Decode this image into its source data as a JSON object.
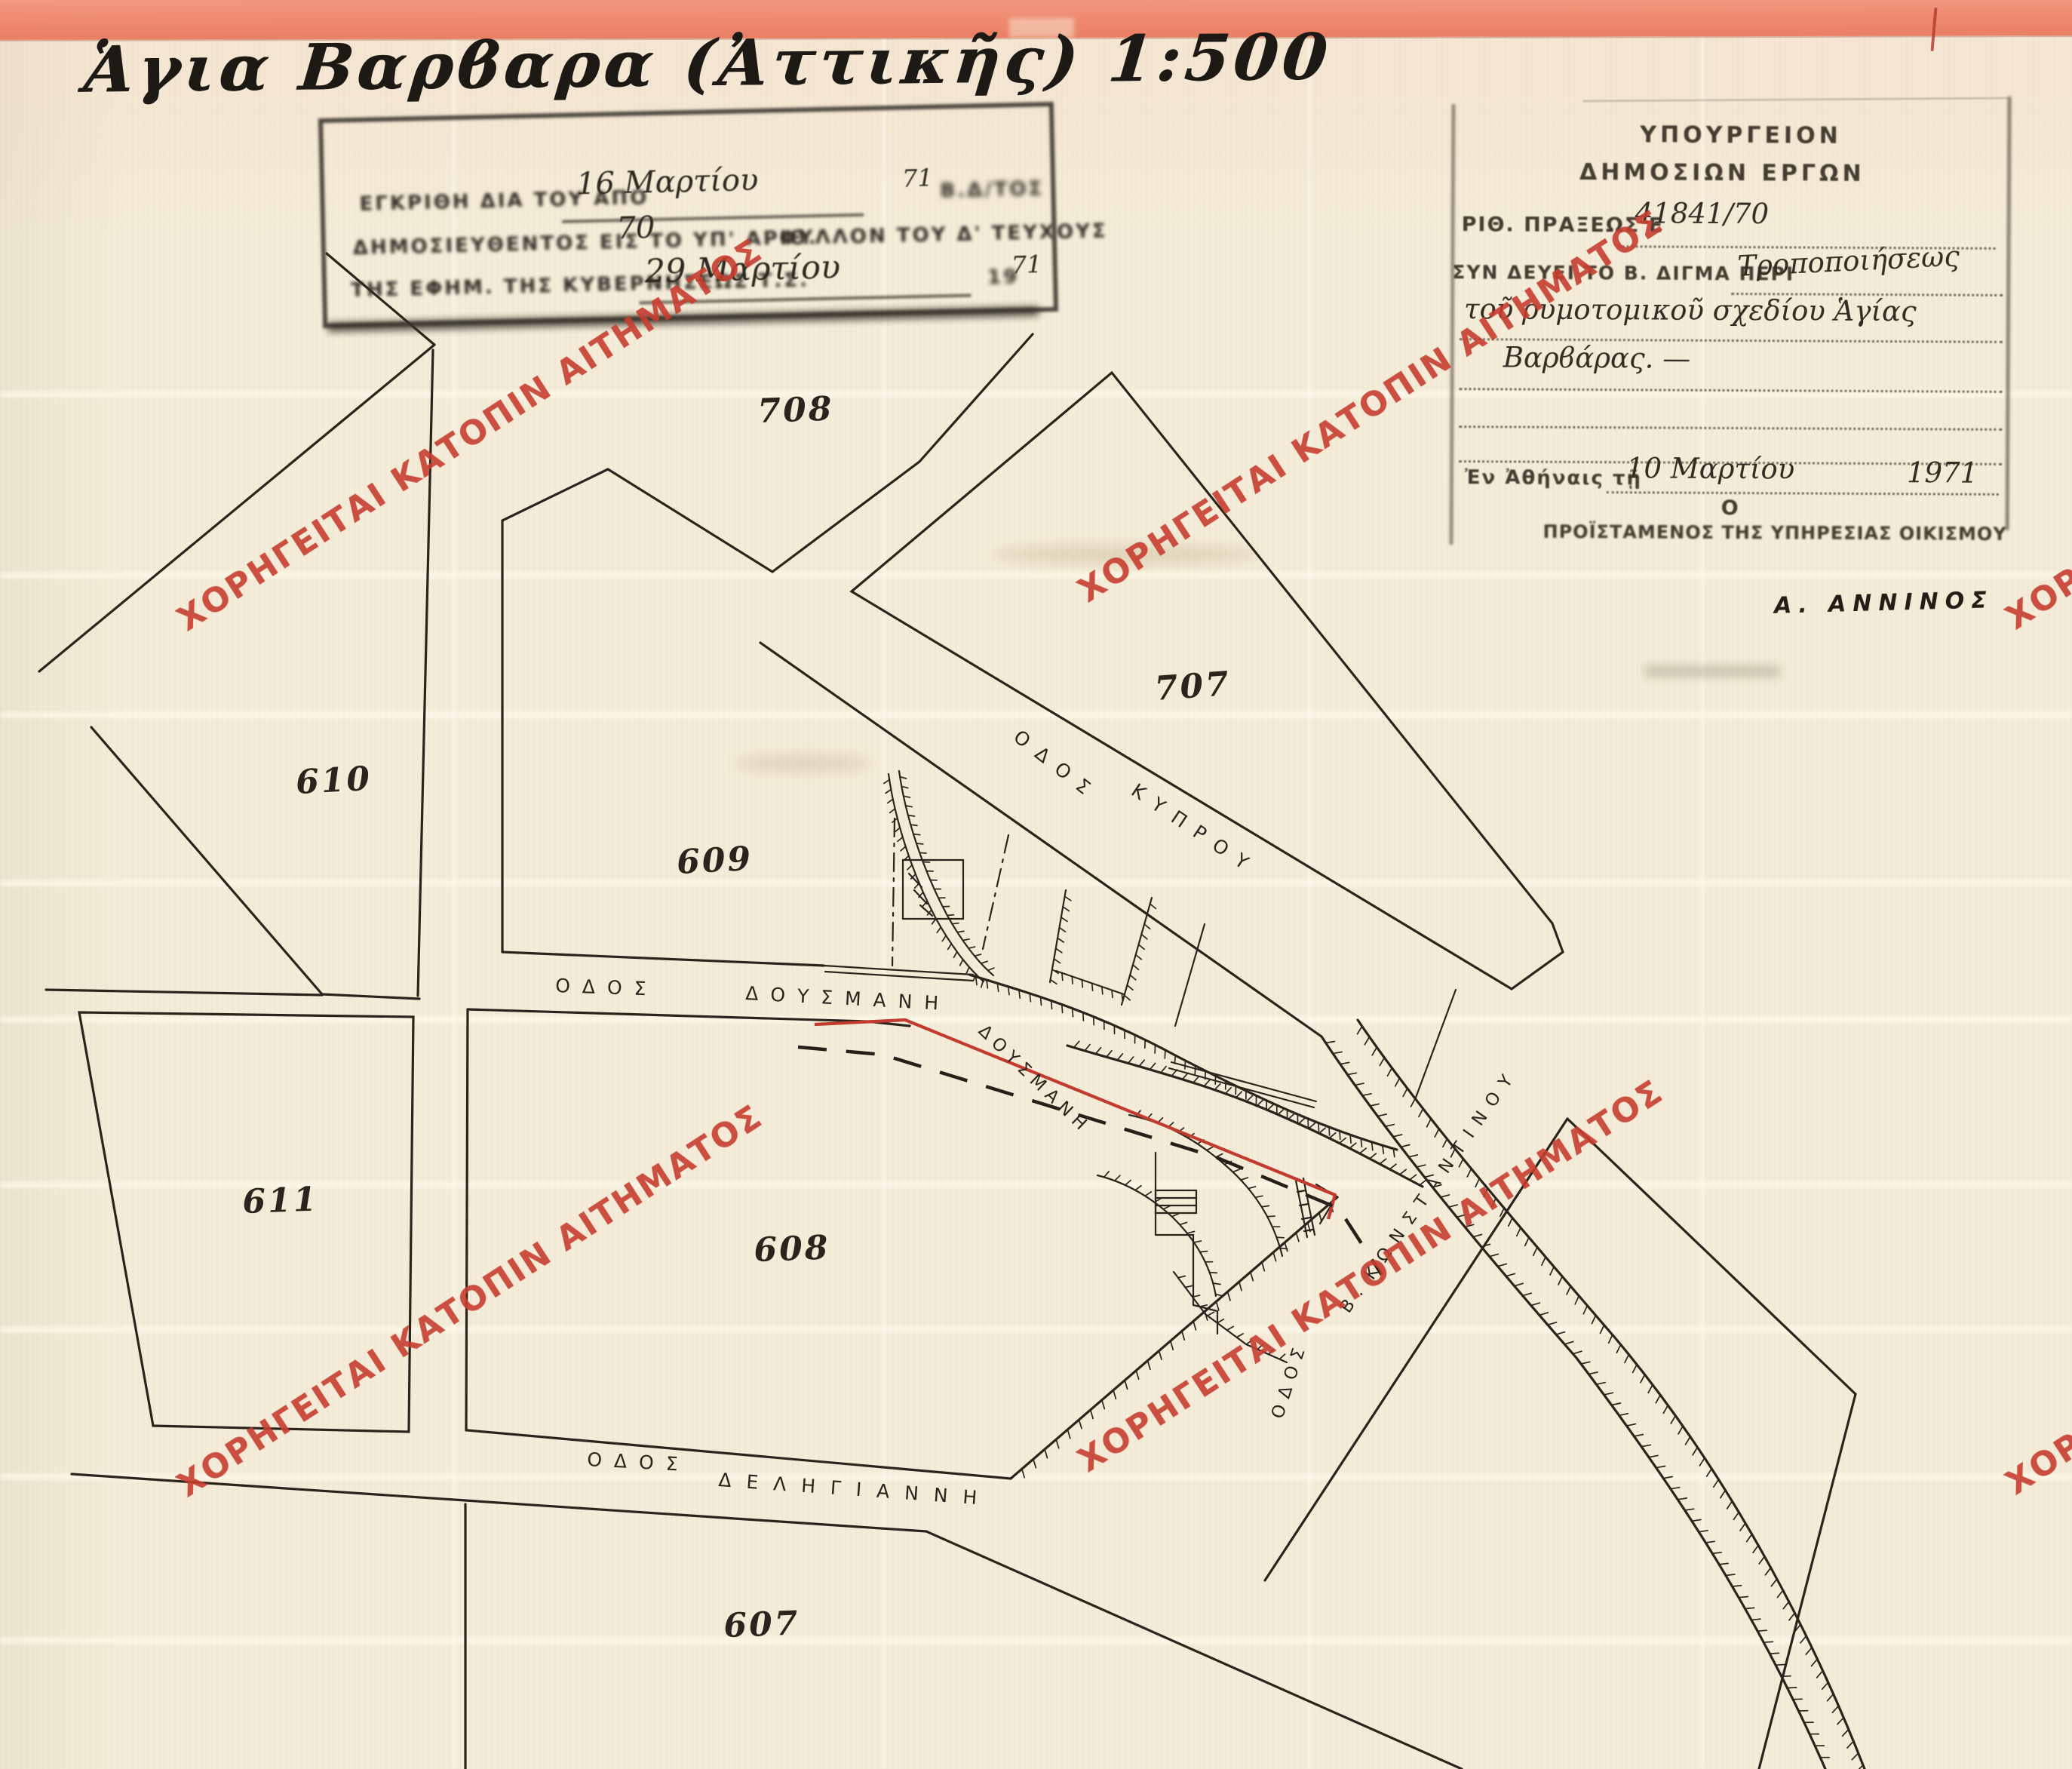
{
  "document": {
    "title": "Ἁγια Βαρϐαρα (Ἀττικῆς) 1:500"
  },
  "watermark": {
    "text": "ΧΟΡΗΓΕΙΤΑΙ ΚΑΤΟΠΙΝ ΑΙΤΗΜΑΤΟΣ",
    "color": "#c63e2f"
  },
  "approval_stamp": {
    "line1_print": "ΕΓΚΡΙΘΗ ΔΙΑ ΤΟΥ ΑΠΟ",
    "line1_date": "16 Μαρτίου",
    "line1_year": "71",
    "line1_tail": "Β.Δ/ΤΟΣ",
    "line2_print": "ΔΗΜΟΣΙΕΥΘΕΝΤΟΣ ΕΙΣ ΤΟ ΥΠ' ΑΡΙΘ.",
    "line2_number": "70",
    "line2_tail": "ΦΥΛΛΟΝ ΤΟΥ Δ' ΤΕΥΧΟΥΣ",
    "line3_print": "ΤΗΣ ΕΦΗΜ. ΤΗΣ ΚΥΒΕΡΝΗΣΕΩΣ Τ.Σ.",
    "line3_date": "29 Μαρτίου",
    "line3_year_print": "19",
    "line3_year": "71"
  },
  "ministry_stamp": {
    "header_line1": "ΥΠΟΥΡΓΕΙΟΝ",
    "header_line2": "ΔΗΜΟΣΙΩΝ ΕΡΓΩΝ",
    "act_label": "ΡΙΘ. ΠΡΑΞΕΩΣ Ε",
    "act_value": "41841/70",
    "decree_label": "ΣΥΝ ΔΕΥΕΙ ΤΟ Β. ΔΙΓΜΑ ΠΕΡΙ",
    "decree_value": "Τροποποιήσεως",
    "decree_value2": "τοῦ ρυμοτομικοῦ σχεδίου Ἁγίας",
    "decree_value3": "Βαρϐάρας. —",
    "place_date_label": "Ἐν Ἀθήναις τῇ",
    "date_value": "10 Μαρτίου",
    "year_value": "1971",
    "signatory_article": "Ο",
    "signatory_title": "ΠΡΟΪΣΤΑΜΕΝΟΣ ΤΗΣ ΥΠΗΡΕΣΙΑΣ ΟΙΚΙΣΜΟΥ"
  },
  "signature": {
    "name": "Α. ΑΝΝΙΝΟΣ"
  },
  "map": {
    "blocks": [
      {
        "label": "708"
      },
      {
        "label": "707"
      },
      {
        "label": "610"
      },
      {
        "label": "609"
      },
      {
        "label": "611"
      },
      {
        "label": "608"
      },
      {
        "label": "607"
      }
    ],
    "streets": {
      "kyprou_odos": "ΟΔΟΣ",
      "kyprou_name": "ΚΥΠΡΟΥ",
      "dousmani_odos": "ΟΔΟΣ",
      "dousmani_name": "ΔΟΥΣΜΑΝΗ",
      "dousmani_realigned": "ΔΟΥΣΜΑΝΗ",
      "deligianni_odos": "ΟΔΟΣ",
      "deligianni_name": "ΔΕΛΗΓΙΑΝΝΗ",
      "konstantinou_odos": "ΟΔΟΣ",
      "konstantinou_prefix": "Β.",
      "konstantinou_name": "ΚΩΝΣΤΑΝΤΙΝΟΥ"
    },
    "colors": {
      "ink": "#2b241d",
      "realignment_red": "#c23b2e",
      "paper": "#f4ecd8",
      "border_pink": "#ef8a71"
    }
  }
}
